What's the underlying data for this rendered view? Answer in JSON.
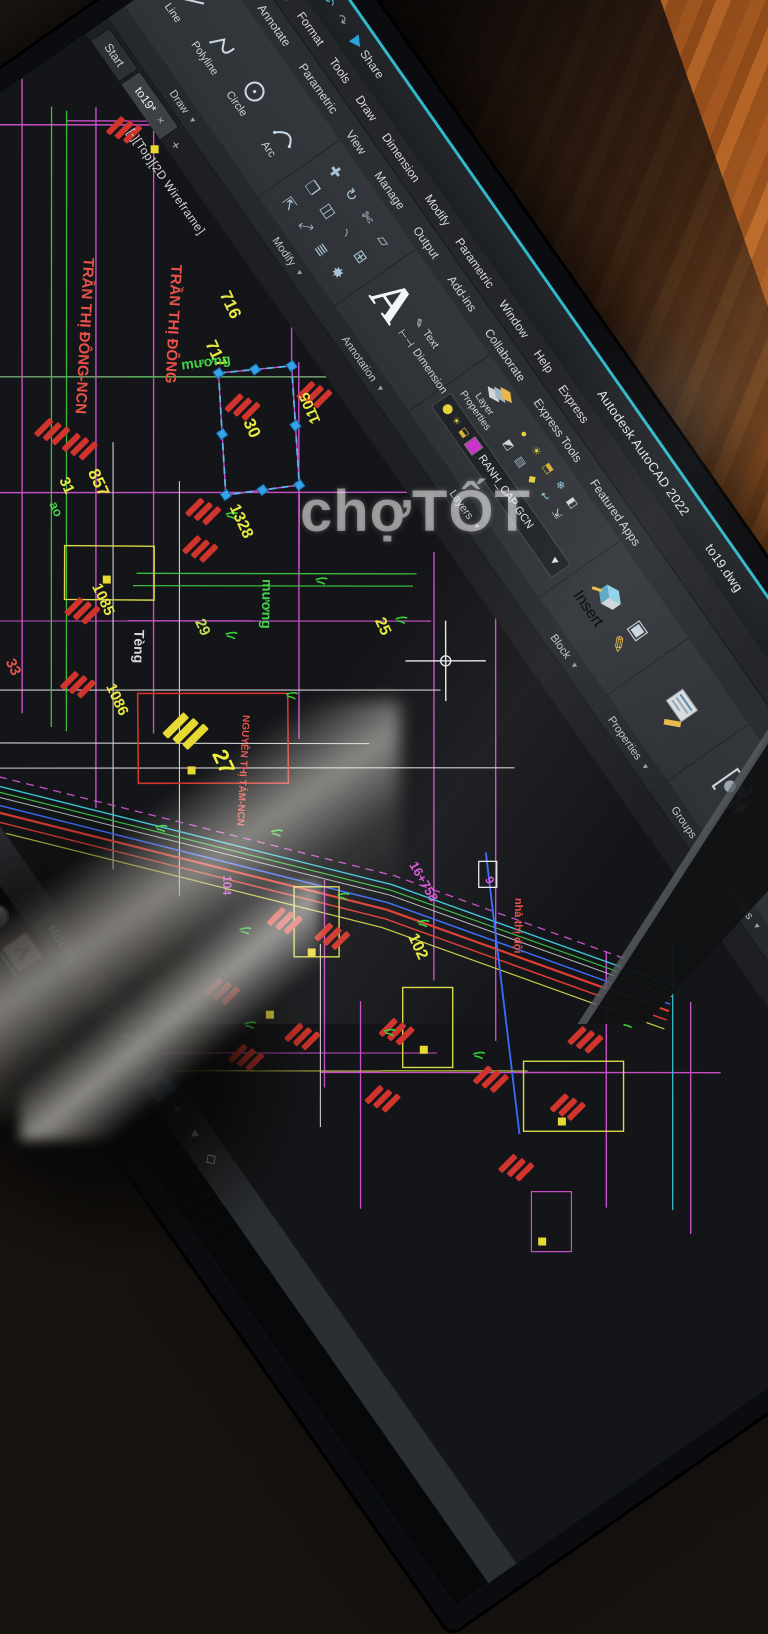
{
  "window": {
    "app_title": "Autodesk AutoCAD 2022",
    "doc_name": "to19.dwg",
    "share_label": "Share",
    "search_placeholder": "Type a keyword or phrase",
    "sign_in_label": "Sig",
    "accent_color": "#2fbac9"
  },
  "menu": {
    "items": [
      "View",
      "Insert",
      "Format",
      "Tools",
      "Draw",
      "Dimension",
      "Modify",
      "Parametric",
      "Window",
      "Help",
      "Express"
    ]
  },
  "ribbon": {
    "tabs": [
      "Insert",
      "Annotate",
      "Parametric",
      "View",
      "Manage",
      "Output",
      "Add-ins",
      "Collaborate",
      "Express Tools",
      "Featured Apps"
    ],
    "panels": {
      "draw": {
        "label": "Draw",
        "tools": [
          "Line",
          "Polyline",
          "Circle",
          "Arc"
        ]
      },
      "modify": {
        "label": "Modify"
      },
      "annotation": {
        "label": "Annotation",
        "tools": [
          "Text",
          "Dimension"
        ]
      },
      "layers": {
        "label": "Layers",
        "layer_properties": "Layer Properties",
        "current_layer": "RANH_CAP GCN",
        "layer_swatch": "#cc33cc"
      },
      "block": {
        "label": "Block",
        "insert_label": "Insert"
      },
      "properties": {
        "label": "Properties"
      },
      "groups": {
        "label": "Groups"
      },
      "utilities": {
        "label": "Utilities"
      },
      "clipboard": {
        "label": "Clipboard"
      }
    }
  },
  "file_tabs": {
    "start": "Start",
    "drawing": "to19*",
    "close_glyph": "×",
    "new_glyph": "+"
  },
  "viewport_label": "[-][Top][2D Wireframe]",
  "command": {
    "tooltip": "Press ESC or ENTER to exit, or right-click to display shortcut",
    "history": "Command: *Cancel*",
    "current": "Command:"
  },
  "status": {
    "model_label": "MODEL",
    "icons": [
      {
        "name": "grid-icon",
        "glyph": "#",
        "highlight": false
      },
      {
        "name": "snap-icon",
        "glyph": "∷",
        "highlight": false
      },
      {
        "name": "flyout-icon",
        "glyph": "▾",
        "highlight": false
      },
      {
        "name": "ortho-icon",
        "glyph": "⊥",
        "highlight": false
      },
      {
        "name": "dynamic-ucs-icon",
        "glyph": "⌖",
        "highlight": true
      },
      {
        "name": "polar-icon",
        "glyph": "+",
        "highlight": false
      },
      {
        "name": "flyout2-icon",
        "glyph": "▾",
        "highlight": false
      },
      {
        "name": "isodraft-icon",
        "glyph": "◇",
        "highlight": false
      }
    ]
  },
  "watermark": {
    "text": "chợTỐT"
  },
  "drawing": {
    "labels": [
      {
        "text": "TRẦN THỊ ĐÔNG-NCN",
        "x": 182,
        "y": 130,
        "rot": 38,
        "size": 15,
        "color": "#e8524a"
      },
      {
        "text": "TRẦN THỊ ĐÔNG",
        "x": 238,
        "y": 62,
        "rot": 38,
        "size": 15,
        "color": "#e8524a"
      },
      {
        "text": "716",
        "x": 290,
        "y": 40,
        "rot": 10,
        "size": 17,
        "color": "#e8e840"
      },
      {
        "text": "717",
        "x": 322,
        "y": 80,
        "rot": 10,
        "size": 17,
        "color": "#e8e840"
      },
      {
        "text": "mương",
        "x": 330,
        "y": 114,
        "rot": -62,
        "size": 14,
        "color": "#46d44a"
      },
      {
        "text": "mương",
        "x": 548,
        "y": 168,
        "rot": 36,
        "size": 14,
        "color": "#46d44a"
      },
      {
        "text": "30",
        "x": 408,
        "y": 94,
        "rot": 10,
        "size": 17,
        "color": "#e8e840"
      },
      {
        "text": "1105",
        "x": 452,
        "y": 30,
        "rot": 192,
        "size": 15,
        "color": "#e8e840"
      },
      {
        "text": "857",
        "x": 360,
        "y": 250,
        "rot": 10,
        "size": 17,
        "color": "#e8e840"
      },
      {
        "text": "31",
        "x": 350,
        "y": 278,
        "rot": 10,
        "size": 15,
        "color": "#e8e840"
      },
      {
        "text": "ao",
        "x": 364,
        "y": 300,
        "rot": 10,
        "size": 13,
        "color": "#46d44a"
      },
      {
        "text": "1328",
        "x": 470,
        "y": 154,
        "rot": 10,
        "size": 16,
        "color": "#e8e840"
      },
      {
        "text": "1085",
        "x": 456,
        "y": 312,
        "rot": 10,
        "size": 15,
        "color": "#e8e840"
      },
      {
        "text": "Tèng",
        "x": 516,
        "y": 302,
        "rot": 36,
        "size": 14,
        "color": "#d8d8d8"
      },
      {
        "text": "29",
        "x": 544,
        "y": 248,
        "rot": 10,
        "size": 15,
        "color": "#bfe050"
      },
      {
        "text": "25",
        "x": 646,
        "y": 100,
        "rot": 10,
        "size": 16,
        "color": "#e8e840"
      },
      {
        "text": "NGUYỄN THỊ TÁM-NCN",
        "x": 648,
        "y": 262,
        "rot": 38,
        "size": 10,
        "color": "#e8524a"
      },
      {
        "text": "27",
        "x": 662,
        "y": 310,
        "rot": 10,
        "size": 22,
        "color": "#f0f03c"
      },
      {
        "text": "1086",
        "x": 546,
        "y": 358,
        "rot": 10,
        "size": 15,
        "color": "#e8e840"
      },
      {
        "text": "33",
        "x": 468,
        "y": 426,
        "rot": 10,
        "size": 15,
        "color": "#e8524a"
      },
      {
        "text": "102",
        "x": 924,
        "y": 254,
        "rot": 10,
        "size": 16,
        "color": "#e8e840"
      },
      {
        "text": "16+758",
        "x": 866,
        "y": 212,
        "rot": 5,
        "size": 13,
        "color": "#d455d4"
      },
      {
        "text": "9",
        "x": 921,
        "y": 158,
        "rot": 10,
        "size": 12,
        "color": "#d455d4"
      },
      {
        "text": "nhà thị đội",
        "x": 954,
        "y": 144,
        "rot": 36,
        "size": 11,
        "color": "#e8524a"
      },
      {
        "text": "104",
        "x": 768,
        "y": 370,
        "rot": 36,
        "size": 12,
        "color": "#d455d4"
      }
    ],
    "trees": [
      [
        474,
        155
      ],
      [
        579,
        119
      ],
      [
        656,
        209
      ],
      [
        657,
        76
      ],
      [
        572,
        224
      ],
      [
        850,
        282
      ],
      [
        918,
        232
      ],
      [
        988,
        322
      ],
      [
        1058,
        262
      ],
      [
        822,
        382
      ],
      [
        1118,
        122
      ],
      [
        902,
        432
      ],
      [
        760,
        300
      ],
      [
        690,
        392
      ]
    ],
    "hatches": [
      [
        316,
        240
      ],
      [
        344,
        226
      ],
      [
        405,
        70
      ],
      [
        436,
        4
      ],
      [
        468,
        162
      ],
      [
        497,
        186
      ],
      [
        480,
        318
      ],
      [
        538,
        364
      ],
      [
        452,
        430
      ],
      [
        432,
        452
      ],
      [
        850,
        330
      ],
      [
        890,
        300
      ],
      [
        955,
        382
      ],
      [
        1005,
        302
      ],
      [
        1052,
        352
      ],
      [
        1098,
        252
      ],
      [
        872,
        422
      ],
      [
        940,
        440
      ],
      [
        1120,
        152
      ],
      [
        1165,
        205
      ],
      [
        1185,
        282
      ],
      [
        110,
        8
      ]
    ],
    "yellow_hatch": [
      640,
      298
    ],
    "markers": [
      [
        455,
        292
      ],
      [
        878,
        338
      ],
      [
        1022,
        302
      ],
      [
        1160,
        230
      ],
      [
        905,
        408
      ],
      [
        660,
        332
      ],
      [
        1247,
        315
      ],
      [
        130,
        6
      ]
    ]
  }
}
